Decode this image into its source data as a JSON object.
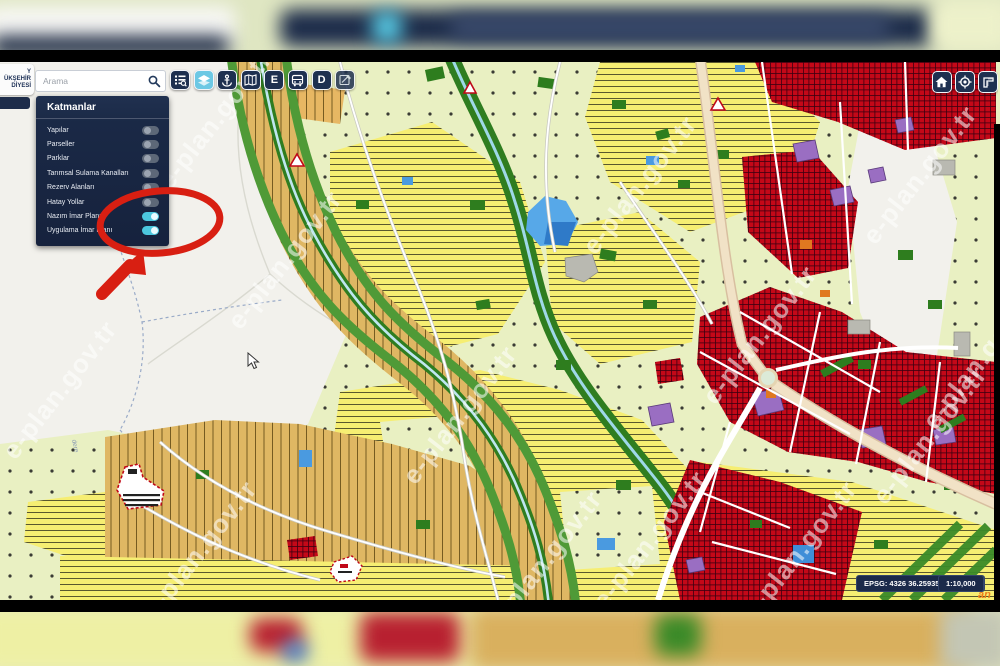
{
  "frame": {
    "watermark_text": "e-plan.gov.tr"
  },
  "logo": {
    "line1": "Y",
    "line2": "ÜKŞEHİR",
    "line3": "DİYESİ"
  },
  "search": {
    "placeholder": "Arama"
  },
  "toolbar": {
    "buttons": [
      {
        "name": "query-legend",
        "icon": "list-magnifier-icon"
      },
      {
        "name": "layers",
        "icon": "layers-icon",
        "active": true
      },
      {
        "name": "location-anchor",
        "icon": "anchor-icon"
      },
      {
        "name": "basemap",
        "icon": "map-icon"
      },
      {
        "name": "e-button",
        "label": "E"
      },
      {
        "name": "transit",
        "icon": "bus-icon"
      },
      {
        "name": "d-button",
        "label": "D"
      },
      {
        "name": "draw-edit",
        "icon": "map-edit-icon"
      }
    ],
    "letter_e": "E",
    "letter_d": "D"
  },
  "nav_right": [
    {
      "name": "home",
      "icon": "home-icon"
    },
    {
      "name": "locate",
      "icon": "target-icon"
    },
    {
      "name": "measure",
      "icon": "ruler-icon"
    }
  ],
  "layers_panel": {
    "title": "Katmanlar",
    "items": [
      {
        "label": "Yapılar",
        "enabled": false
      },
      {
        "label": "Parseller",
        "enabled": false
      },
      {
        "label": "Parklar",
        "enabled": false
      },
      {
        "label": "Tarımsal Sulama Kanalları",
        "enabled": false
      },
      {
        "label": "Rezerv Alanları",
        "enabled": false
      },
      {
        "label": "Hatay Yollar",
        "enabled": false
      },
      {
        "label": "Nazım İmar Planı",
        "enabled": true
      },
      {
        "label": "Uygulama İmar Planı",
        "enabled": true
      }
    ]
  },
  "map_labels": {
    "stream": "dere"
  },
  "status": {
    "epsg": "EPSG: 4326 36.25935 - 36.14102",
    "scale": "1:10,000",
    "partial_logo": "an"
  },
  "palette": {
    "panel_navy": "#1a2946",
    "button_navy": "#1e3050",
    "active_button_blue": "#6cc8e4",
    "toggle_on_cyan": "#4cc7de",
    "zone_orchard_green": "#e9f0c2",
    "zone_agriculture_yellow": "#f6ee72",
    "zone_village_tan": "#dfb763",
    "zone_residential_red": "#c40818",
    "zone_purple": "#9a6ec2",
    "zone_blue": "#4a9ae0",
    "zone_green": "#2e7d1e",
    "annotation_red": "#d81f12"
  }
}
